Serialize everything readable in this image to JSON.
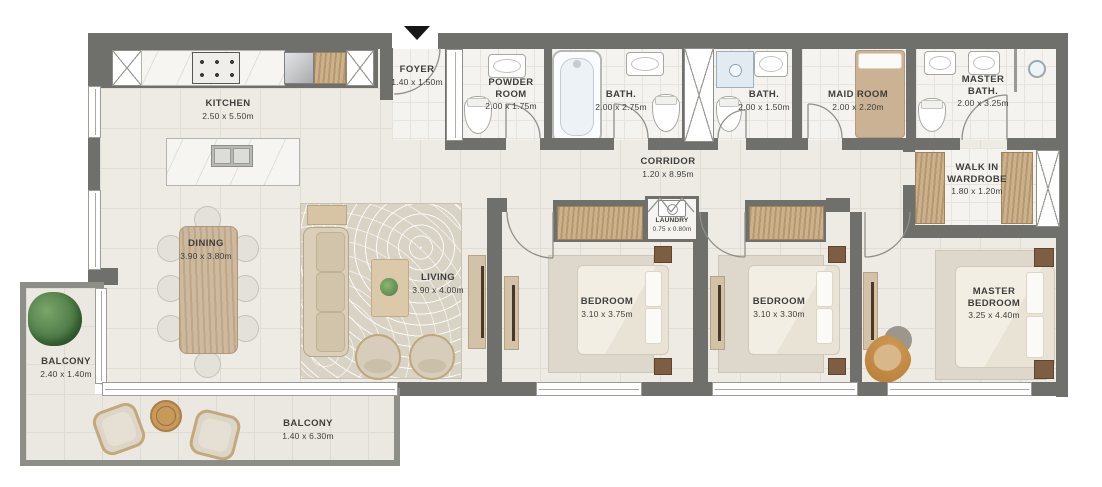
{
  "plan": {
    "rooms": {
      "kitchen": {
        "name": "KITCHEN",
        "dims": "2.50 x 5.50m"
      },
      "foyer": {
        "name": "FOYER",
        "dims": "1.40 x 1.50m"
      },
      "powder_room": {
        "name": "POWDER ROOM",
        "dims": "2.00 x 1.75m"
      },
      "bath_1": {
        "name": "BATH.",
        "dims": "2.00 x 2.75m"
      },
      "bath_2": {
        "name": "BATH.",
        "dims": "2.00 x 1.50m"
      },
      "maid_room": {
        "name": "MAID ROOM",
        "dims": "2.00 x 2.20m"
      },
      "master_bath": {
        "name": "MASTER BATH.",
        "dims": "2.00 x 3.25m"
      },
      "corridor": {
        "name": "CORRIDOR",
        "dims": "1.20 x 8.95m"
      },
      "laundry": {
        "name": "LAUNDRY",
        "dims": "0.75 x 0.80m"
      },
      "walk_in_wardrobe": {
        "name": "WALK IN WARDROBE",
        "dims": "1.80 x 1.20m"
      },
      "dining": {
        "name": "DINING",
        "dims": "3.90 x 3.80m"
      },
      "living": {
        "name": "LIVING",
        "dims": "3.90 x 4.00m"
      },
      "bedroom_1": {
        "name": "BEDROOM",
        "dims": "3.10 x 3.75m"
      },
      "bedroom_2": {
        "name": "BEDROOM",
        "dims": "3.10 x 3.30m"
      },
      "master_bedroom": {
        "name": "MASTER BEDROOM",
        "dims": "3.25 x 4.40m"
      },
      "balcony_side": {
        "name": "BALCONY",
        "dims": "2.40 x 1.40m"
      },
      "balcony_main": {
        "name": "BALCONY",
        "dims": "1.40 x 6.30m"
      }
    },
    "colors": {
      "wall": "#6f6f6c",
      "wallLight": "#8e8e89",
      "floor": "#edebe4",
      "floorLine": "#e0ded4",
      "bathFloor": "#f4f3ef",
      "balconyFloor": "#eae8e0",
      "wood": "#c6a97f",
      "woodDark": "#7d5e42",
      "rug": "#d9d3c5",
      "accentChair": "#b57b34",
      "windowFill": "#ffffff",
      "text": "#3e3e3c",
      "green": "#4c7a45"
    }
  }
}
